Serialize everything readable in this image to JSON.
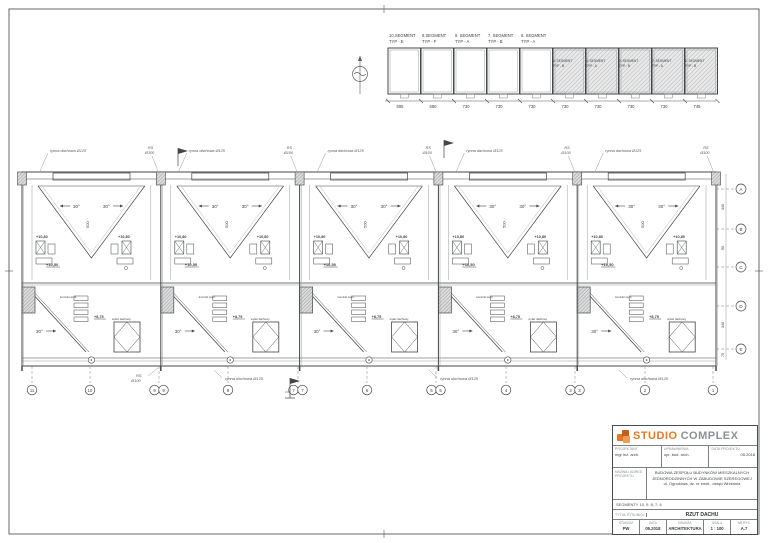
{
  "colors": {
    "accent_orange": "#e87722",
    "logo_gray": "#8d9196",
    "line": "#44474a",
    "hatch": "#b0b3b6"
  },
  "keyplan": {
    "top_labels": [
      {
        "l1": "10.SEGMENT",
        "l2": "TYP - E"
      },
      {
        "l1": "9.SEGMENT",
        "l2": "TYP - F"
      },
      {
        "l1": "8. SEGMENT",
        "l2": "TYP - A"
      },
      {
        "l1": "7. SEGMENT",
        "l2": "TYP - B"
      },
      {
        "l1": "6. SEGMENT",
        "l2": "TYP - A"
      }
    ],
    "in_labels": [
      {
        "l1": "5. SEGMENT",
        "l2": "TYP - B"
      },
      {
        "l1": "4. SEGMENT",
        "l2": "TYP - A"
      },
      {
        "l1": "3. SEGMENT",
        "l2": "TYP - B"
      },
      {
        "l1": "2. SEGMENT",
        "l2": "TYP - A"
      },
      {
        "l1": "1. SEGMENT",
        "l2": "TYP - B"
      }
    ],
    "dims": [
      "695",
      "680",
      "730",
      "730",
      "730",
      "730",
      "730",
      "730",
      "730",
      "745"
    ]
  },
  "drawing": {
    "ann": {
      "gutter_top": "rynna dachowa Ø125",
      "rs": "RS",
      "dia100": "Ø100",
      "downpipe": "RS Ø100",
      "gutter_bottom": "rynna dachowa Ø120",
      "slope": "30°",
      "elev_high": "+10,80",
      "elev_mid": "+10,50",
      "elev_low": "+8,75",
      "dim_span": "500",
      "skylight": "wyłaz dachowy",
      "vents": "kominki went."
    },
    "segment_xs": [
      22,
      160.8,
      299.6,
      438.4,
      577.2
    ],
    "seg_w": 138.8,
    "grid_right": {
      "labels": [
        "A",
        "B",
        "C",
        "D",
        "E"
      ],
      "ys": [
        189,
        229,
        267,
        306,
        349
      ]
    },
    "dims_right": {
      "values": [
        "340",
        "90",
        "340",
        "75"
      ],
      "ys": [
        207,
        248,
        325,
        355
      ]
    },
    "grid_bottom": [
      {
        "x": 32,
        "n": [
          "11"
        ]
      },
      {
        "x": 90,
        "n": [
          "10"
        ]
      },
      {
        "x": 159,
        "n": [
          "9",
          "9"
        ]
      },
      {
        "x": 228,
        "n": [
          "8"
        ]
      },
      {
        "x": 298,
        "n": [
          "7",
          "7"
        ]
      },
      {
        "x": 367,
        "n": [
          "6"
        ]
      },
      {
        "x": 436,
        "n": [
          "5",
          "5"
        ]
      },
      {
        "x": 506,
        "n": [
          "4"
        ]
      },
      {
        "x": 575,
        "n": [
          "3",
          "3"
        ]
      },
      {
        "x": 645,
        "n": [
          "2"
        ]
      },
      {
        "x": 713,
        "n": [
          "1"
        ]
      }
    ]
  },
  "titleblock": {
    "logo": {
      "studio": "STUDIO",
      "complex": "COMPLEX"
    },
    "headers": {
      "projektant": "PROJEKTANT",
      "uprawnienia": "UPRAWNIENIA",
      "data": "DATA PROJEKTU"
    },
    "values": {
      "projektant": "mgr inż. arch.",
      "uprawnienia": "upr. bud. arch.",
      "data": "05.2018"
    },
    "project_label": "NAZWA I ADRES PROJEKTU",
    "project_lines": {
      "l1": "BUDOWA ZESPOŁU BUDYNKÓW MIESZKALNYCH",
      "l2": "JEDNORODZINNYCH W ZABUDOWIE SZEREGOWEJ",
      "l3": "ul. Ogrodowa, dz. nr ewid., obręb Września"
    },
    "segments_line": "SEGMENTY 10, 9, 8, 7, 6",
    "title_label": "TYTUŁ RYSUNKU",
    "title_value": "RZUT DACHU",
    "bottom": {
      "headers": [
        "STADIUM",
        "DATA",
        "BRANŻA",
        "SKALA",
        "NR RYS."
      ],
      "values": [
        "PW",
        "05.2018",
        "ARCHITEKTURA",
        "1 : 100",
        "A.7"
      ]
    }
  }
}
